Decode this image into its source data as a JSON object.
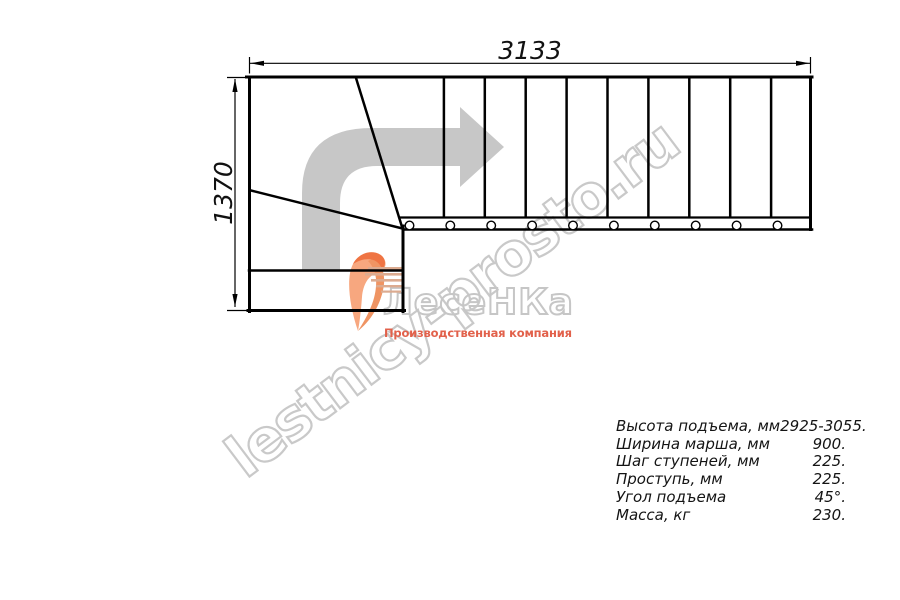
{
  "drawing": {
    "title_semantic": "L-shaped staircase plan, top view",
    "dimensions": {
      "width_mm": "3133",
      "height_mm": "1370"
    },
    "plan": {
      "straight_treads": 10,
      "winder_treads": 3,
      "balusters": 10,
      "direction_arrow_icon": "turn-right-arrow",
      "arrow_color": "#c7c7c7",
      "line_color": "#000000"
    }
  },
  "watermark": {
    "text": "lestnicy-prosto.ru",
    "color": "#c9c9c9"
  },
  "logo": {
    "name": "ЛесеНКа",
    "subtitle": "Производственная компания",
    "swirl_icon": "orange-swoosh",
    "name_outline_color": "#c6c6c6",
    "subtitle_color": "#e2614b",
    "swirl_color": "#f7a77f",
    "swirl_accent_color": "#ef7443",
    "speedline_color": "#dcab90"
  },
  "specs": {
    "rows": [
      {
        "label": "Высота подъема, мм",
        "value": "2925-3055."
      },
      {
        "label": "Ширина марша, мм",
        "value": "900."
      },
      {
        "label": "Шаг ступеней, мм",
        "value": "225."
      },
      {
        "label": "Проступь, мм",
        "value": "225."
      },
      {
        "label": "Угол подъема",
        "value": "45°."
      },
      {
        "label": "Масса, кг",
        "value": "230."
      }
    ]
  }
}
